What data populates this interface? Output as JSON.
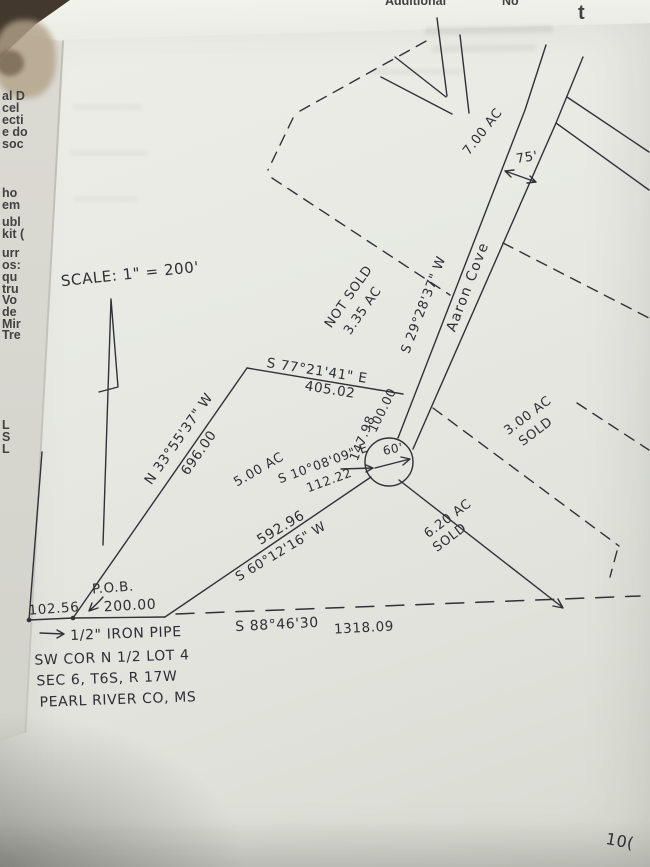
{
  "photo": {
    "page_number": "10(",
    "colors": {
      "ink": "#30303a",
      "paper": "#e8e9e3",
      "under_paper": "#d9d8d1"
    },
    "overlapping_page": {
      "top_fragments": [
        "Additional",
        "No",
        "t"
      ],
      "left_fragments": [
        "al D",
        "cel",
        "ecti",
        "e do",
        "soc",
        "ho",
        "em",
        "ubl",
        "kit (",
        "urr",
        "os:",
        "qu",
        "tru",
        "Vo",
        "de",
        "Mir",
        "Tre",
        "L",
        "S",
        "L"
      ]
    }
  },
  "plat": {
    "scale_label": "SCALE: 1\" = 200'",
    "north_arrow_icon": "north-arrow",
    "road": {
      "name": "Aaron Cove",
      "bearing": "S 29°28'37\" W",
      "width_label": "75'",
      "culdesac_radius_label": "60'",
      "edge_distances": [
        "100.00",
        "147.98"
      ]
    },
    "boundaries": {
      "west_line": {
        "bearing": "N 33°55'37\" W",
        "distance": "696.00"
      },
      "north_line": {
        "bearing": "S 77°21'41\" E",
        "distance": "405.02"
      },
      "southeast_line": {
        "bearing": "S 60°12'16\" W",
        "distance": "592.96"
      },
      "south_line": {
        "bearing": "S 88°46'30",
        "distance": "1318.09"
      },
      "spur_line": {
        "bearing": "S 10°08'09\" E",
        "distance": "112.22"
      },
      "west_offset_distance": "102.56",
      "pob_offset_distance": "200.00"
    },
    "parcels": [
      {
        "area": "7.00 AC",
        "status": ""
      },
      {
        "area": "3.35 AC",
        "status": "NOT SOLD"
      },
      {
        "area": "5.00 AC",
        "status": ""
      },
      {
        "area": "3.00 AC",
        "status": "SOLD"
      },
      {
        "area": "6.20 AC",
        "status": "SOLD"
      }
    ],
    "pob": {
      "label": "P.O.B.",
      "monument": "1/2\" IRON PIPE",
      "description_lines": [
        "SW COR N 1/2 LOT 4",
        "SEC 6, T6S, R 17W",
        "PEARL RIVER CO, MS"
      ]
    }
  }
}
